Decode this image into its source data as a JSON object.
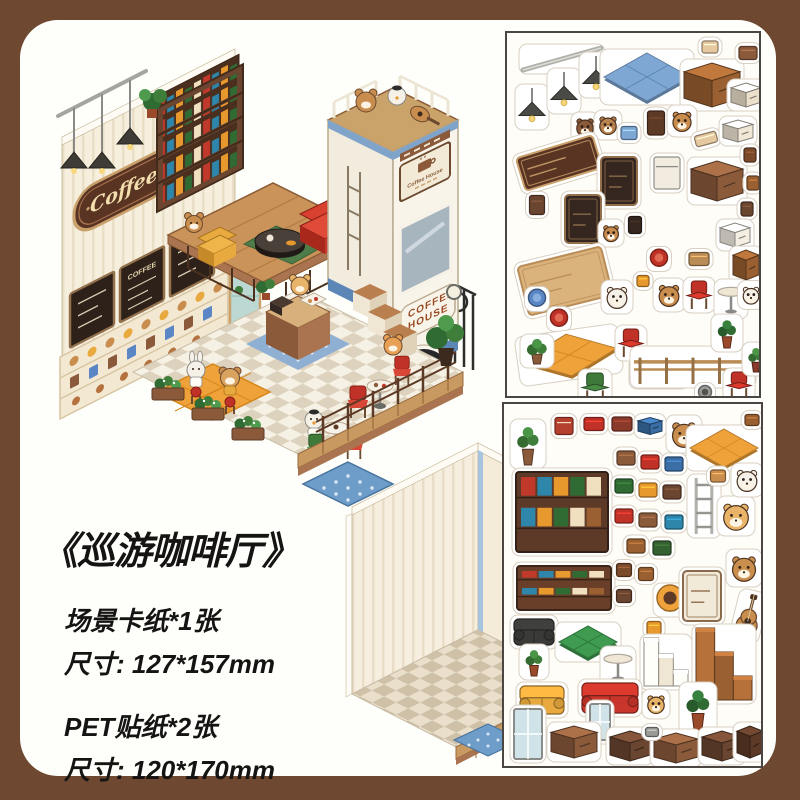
{
  "colors": {
    "frame_brown": "#6e4830",
    "panel_bg": "#fefffb",
    "sheet_bg": "#fffdf8",
    "sheet_border": "#4b4641",
    "accent_red": "#c0392b",
    "accent_orange": "#f0a23a",
    "accent_blue": "#7fa7d4",
    "accent_green": "#3e7d3a",
    "wood_brown": "#8a5a3b"
  },
  "title": "《巡游咖啡厅》",
  "specs": [
    {
      "line": "场景卡纸*1张",
      "size": "尺寸: 127*157mm"
    },
    {
      "line": "PET贴纸*2张",
      "size": "尺寸: 120*170mm"
    }
  ],
  "scene": {
    "name": "coffee-shop-isometric-scene",
    "sign_text": "Coffee",
    "menu_text": "COFFEE",
    "truck_text_line1": "COFFEE",
    "truck_text_line2": "HOUSE",
    "truck_sign_text": "Coffee House"
  },
  "sheets": {
    "top": {
      "name": "pet-sticker-sheet-1",
      "stickers": [
        {
          "n": "curtain-rod",
          "k": "rod",
          "x": 55,
          "y": 26,
          "w": 78,
          "h": 22,
          "c": "#b0b0aa"
        },
        {
          "n": "hanging-lamp",
          "k": "lamp",
          "x": 25,
          "y": 74,
          "w": 26,
          "h": 38,
          "c": "#4a4a46"
        },
        {
          "n": "hanging-lamp",
          "k": "lamp",
          "x": 57,
          "y": 58,
          "w": 26,
          "h": 38,
          "c": "#4a4a46"
        },
        {
          "n": "hanging-lamp",
          "k": "lamp",
          "x": 89,
          "y": 42,
          "w": 26,
          "h": 38,
          "c": "#4a4a46"
        },
        {
          "n": "blue-tile-mat",
          "k": "flat",
          "x": 140,
          "y": 44,
          "w": 86,
          "h": 48,
          "c": "#7fa7d4",
          "c2": "#5b86b5"
        },
        {
          "n": "bun",
          "k": "small",
          "x": 203,
          "y": 14,
          "w": 16,
          "h": 12,
          "c": "#e7c9a1"
        },
        {
          "n": "brown-cabinet",
          "k": "cube",
          "x": 205,
          "y": 52,
          "w": 56,
          "h": 44,
          "c": "#9a6031"
        },
        {
          "n": "snack-tray",
          "k": "small",
          "x": 241,
          "y": 20,
          "w": 18,
          "h": 13,
          "c": "#8a5a3b"
        },
        {
          "n": "white-bench",
          "k": "cube",
          "x": 239,
          "y": 62,
          "w": 30,
          "h": 24,
          "c": "#ece0cc"
        },
        {
          "n": "barista-bear",
          "k": "char",
          "x": 78,
          "y": 94,
          "w": 20,
          "h": 22,
          "c": "#8a5a3b"
        },
        {
          "n": "barista-bear",
          "k": "char",
          "x": 101,
          "y": 92,
          "w": 20,
          "h": 22,
          "c": "#b98350"
        },
        {
          "n": "blue-crate",
          "k": "small",
          "x": 122,
          "y": 100,
          "w": 16,
          "h": 13,
          "c": "#7fa7d4"
        },
        {
          "n": "coffee-grinder",
          "k": "small",
          "x": 149,
          "y": 90,
          "w": 17,
          "h": 24,
          "c": "#5d3a26"
        },
        {
          "n": "bear-on-chair",
          "k": "char",
          "x": 175,
          "y": 88,
          "w": 22,
          "h": 24,
          "c": "#c98d4e"
        },
        {
          "n": "bread",
          "k": "small",
          "x": 199,
          "y": 106,
          "w": 22,
          "h": 11,
          "c": "#e7c9a1",
          "r": -15
        },
        {
          "n": "bread-box",
          "k": "cube",
          "x": 231,
          "y": 98,
          "w": 30,
          "h": 22,
          "c": "#f0e7d6"
        },
        {
          "n": "coffee-sign",
          "k": "panel",
          "x": 52,
          "y": 130,
          "w": 80,
          "h": 34,
          "c": "#5a3423",
          "c2": "#caa06b",
          "r": -17
        },
        {
          "n": "menu-board",
          "k": "panel",
          "x": 112,
          "y": 148,
          "w": 36,
          "h": 48,
          "c": "#35271f",
          "c2": "#93704c"
        },
        {
          "n": "coffee-machine",
          "k": "small",
          "x": 160,
          "y": 140,
          "w": 26,
          "h": 32,
          "c": "#f2ece0",
          "c2": "#8a8a86"
        },
        {
          "n": "counter-cube",
          "k": "cube",
          "x": 210,
          "y": 148,
          "w": 52,
          "h": 40,
          "c": "#8a5a3b"
        },
        {
          "n": "jar",
          "k": "small",
          "x": 243,
          "y": 122,
          "w": 12,
          "h": 14,
          "c": "#7a4a2a"
        },
        {
          "n": "jar",
          "k": "small",
          "x": 246,
          "y": 150,
          "w": 12,
          "h": 14,
          "c": "#9a6031"
        },
        {
          "n": "jar",
          "k": "small",
          "x": 240,
          "y": 176,
          "w": 12,
          "h": 14,
          "c": "#6a4530"
        },
        {
          "n": "menu-board",
          "k": "panel",
          "x": 76,
          "y": 186,
          "w": 36,
          "h": 48,
          "c": "#35271f",
          "c2": "#93704c"
        },
        {
          "n": "wall-frame",
          "k": "small",
          "x": 30,
          "y": 172,
          "w": 15,
          "h": 19,
          "c": "#6a4530"
        },
        {
          "n": "glass-cover",
          "k": "cube",
          "x": 228,
          "y": 202,
          "w": 30,
          "h": 24,
          "c": "#f5efe3"
        },
        {
          "n": "bear-face",
          "k": "char",
          "x": 104,
          "y": 200,
          "w": 18,
          "h": 20,
          "c": "#c98d4e"
        },
        {
          "n": "wall-frame",
          "k": "small",
          "x": 128,
          "y": 192,
          "w": 13,
          "h": 17,
          "c": "#35271f"
        },
        {
          "n": "red-stool",
          "k": "round",
          "x": 152,
          "y": 226,
          "w": 17,
          "h": 17,
          "c": "#c03227",
          "c2": "#e06a54"
        },
        {
          "n": "wood-wall-panel",
          "k": "panel",
          "x": 58,
          "y": 248,
          "w": 86,
          "h": 50,
          "c": "#d9b27c",
          "c2": "#b98c55",
          "r": -14
        },
        {
          "n": "basket",
          "k": "small",
          "x": 192,
          "y": 226,
          "w": 20,
          "h": 13,
          "c": "#b98c55"
        },
        {
          "n": "display-case",
          "k": "cube",
          "x": 239,
          "y": 232,
          "w": 26,
          "h": 30,
          "c": "#9a6031"
        },
        {
          "n": "blue-stool",
          "k": "round",
          "x": 30,
          "y": 266,
          "w": 17,
          "h": 17,
          "c": "#5b86c5",
          "c2": "#88aede"
        },
        {
          "n": "red-stool",
          "k": "round",
          "x": 52,
          "y": 286,
          "w": 17,
          "h": 17,
          "c": "#c03227",
          "c2": "#e06a54"
        },
        {
          "n": "rabbit",
          "k": "char",
          "x": 110,
          "y": 264,
          "w": 24,
          "h": 26,
          "c": "#f5f1e8"
        },
        {
          "n": "coffee-cup",
          "k": "small",
          "x": 136,
          "y": 248,
          "w": 12,
          "h": 11,
          "c": "#e8992d"
        },
        {
          "n": "bear",
          "k": "char",
          "x": 162,
          "y": 262,
          "w": 24,
          "h": 26,
          "c": "#c98d4e"
        },
        {
          "n": "red-chair",
          "k": "chair",
          "x": 192,
          "y": 262,
          "w": 24,
          "h": 28,
          "c": "#c03227"
        },
        {
          "n": "round-table",
          "k": "table",
          "x": 224,
          "y": 266,
          "w": 26,
          "h": 32,
          "c": "#efe6d4",
          "c2": "#8a8a86"
        },
        {
          "n": "duck",
          "k": "char",
          "x": 244,
          "y": 262,
          "w": 19,
          "h": 21,
          "c": "#f5f1e8"
        },
        {
          "n": "orange-tile-mat",
          "k": "flat",
          "x": 62,
          "y": 322,
          "w": 96,
          "h": 42,
          "c": "#f0a23a",
          "c2": "#d6871d",
          "r": -8
        },
        {
          "n": "red-chair",
          "k": "chair",
          "x": 124,
          "y": 310,
          "w": 24,
          "h": 28,
          "c": "#c03227"
        },
        {
          "n": "striped-rug",
          "k": "rug",
          "x": 152,
          "y": 340,
          "w": 52,
          "h": 24,
          "c": "#e9f0e2",
          "c2": "#7ab97a"
        },
        {
          "n": "green-chair",
          "k": "chair",
          "x": 88,
          "y": 354,
          "w": 26,
          "h": 28,
          "c": "#3f7a3b"
        },
        {
          "n": "wood-fence",
          "k": "fence",
          "x": 186,
          "y": 334,
          "w": 118,
          "h": 34,
          "c": "#b98c55"
        },
        {
          "n": "planter-box",
          "k": "plant",
          "x": 30,
          "y": 318,
          "w": 26,
          "h": 26,
          "c": "#3e7d3a",
          "c2": "#8a5a3b"
        },
        {
          "n": "potted-plant",
          "k": "plant",
          "x": 220,
          "y": 300,
          "w": 24,
          "h": 30,
          "c": "#2f6b33",
          "c2": "#9a4a2a"
        },
        {
          "n": "red-chair",
          "k": "chair",
          "x": 232,
          "y": 352,
          "w": 24,
          "h": 26,
          "c": "#c03227"
        },
        {
          "n": "potted-plant",
          "k": "plant",
          "x": 249,
          "y": 326,
          "w": 20,
          "h": 26,
          "c": "#3e7d3a",
          "c2": "#8a3a2a"
        },
        {
          "n": "pet-bowl",
          "k": "round",
          "x": 198,
          "y": 360,
          "w": 13,
          "h": 13,
          "c": "#9a9a96",
          "c2": "#55514d"
        }
      ]
    },
    "bottom": {
      "name": "pet-sticker-sheet-2",
      "stickers": [
        {
          "n": "hanging-plant",
          "k": "plant",
          "x": 24,
          "y": 40,
          "w": 28,
          "h": 42,
          "c": "#3e7d3a",
          "c2": "#8a5a3b"
        },
        {
          "n": "wall-frame",
          "k": "small",
          "x": 60,
          "y": 22,
          "w": 18,
          "h": 17,
          "c": "#b5402f",
          "c2": "#f0e0c0"
        },
        {
          "n": "bento",
          "k": "small",
          "x": 90,
          "y": 20,
          "w": 20,
          "h": 13,
          "c": "#c03227"
        },
        {
          "n": "books-stack",
          "k": "small",
          "x": 118,
          "y": 20,
          "w": 20,
          "h": 14,
          "c": "#8a3a2a"
        },
        {
          "n": "blue-tray",
          "k": "cube",
          "x": 146,
          "y": 22,
          "w": 24,
          "h": 17,
          "c": "#3a6ea5"
        },
        {
          "n": "bear-reading",
          "k": "char",
          "x": 180,
          "y": 30,
          "w": 28,
          "h": 30,
          "c": "#c98d4e"
        },
        {
          "n": "orange-mat",
          "k": "flat",
          "x": 220,
          "y": 44,
          "w": 68,
          "h": 38,
          "c": "#f0a23a",
          "c2": "#d6871d"
        },
        {
          "n": "snack",
          "k": "small",
          "x": 248,
          "y": 16,
          "w": 14,
          "h": 11,
          "c": "#9a6031"
        },
        {
          "n": "bookshelf",
          "k": "shelf",
          "x": 58,
          "y": 108,
          "w": 92,
          "h": 80,
          "c": "#5d3a28"
        },
        {
          "n": "book-sticker",
          "k": "small",
          "x": 122,
          "y": 54,
          "w": 18,
          "h": 14,
          "c": "#8a5a3b"
        },
        {
          "n": "book-sticker",
          "k": "small",
          "x": 146,
          "y": 58,
          "w": 18,
          "h": 14,
          "c": "#c03227"
        },
        {
          "n": "book-sticker",
          "k": "small",
          "x": 170,
          "y": 60,
          "w": 18,
          "h": 14,
          "c": "#3a6ea5"
        },
        {
          "n": "book-sticker",
          "k": "small",
          "x": 120,
          "y": 82,
          "w": 18,
          "h": 14,
          "c": "#2f6b33"
        },
        {
          "n": "book-sticker",
          "k": "small",
          "x": 144,
          "y": 86,
          "w": 18,
          "h": 14,
          "c": "#e8992d"
        },
        {
          "n": "book-sticker",
          "k": "small",
          "x": 168,
          "y": 88,
          "w": 18,
          "h": 14,
          "c": "#6a4530"
        },
        {
          "n": "book-sticker",
          "k": "small",
          "x": 120,
          "y": 112,
          "w": 18,
          "h": 14,
          "c": "#c03227"
        },
        {
          "n": "book-sticker",
          "k": "small",
          "x": 144,
          "y": 116,
          "w": 18,
          "h": 14,
          "c": "#8a5a3b"
        },
        {
          "n": "book-sticker",
          "k": "small",
          "x": 170,
          "y": 118,
          "w": 18,
          "h": 14,
          "c": "#2e86ab"
        },
        {
          "n": "book-sticker",
          "k": "small",
          "x": 132,
          "y": 142,
          "w": 18,
          "h": 14,
          "c": "#9a6031"
        },
        {
          "n": "book-sticker",
          "k": "small",
          "x": 158,
          "y": 144,
          "w": 18,
          "h": 14,
          "c": "#35602f"
        },
        {
          "n": "ladder",
          "k": "ladder",
          "x": 200,
          "y": 102,
          "w": 26,
          "h": 56,
          "c": "#b0b0aa"
        },
        {
          "n": "bear",
          "k": "char",
          "x": 232,
          "y": 112,
          "w": 30,
          "h": 32,
          "c": "#e8b46a"
        },
        {
          "n": "white-cat",
          "k": "char",
          "x": 243,
          "y": 76,
          "w": 24,
          "h": 26,
          "c": "#f5f1e8"
        },
        {
          "n": "cookie",
          "k": "small",
          "x": 214,
          "y": 72,
          "w": 15,
          "h": 12,
          "c": "#c98d4e"
        },
        {
          "n": "tv-console",
          "k": "shelf",
          "x": 60,
          "y": 184,
          "w": 94,
          "h": 44,
          "c": "#6a3f2a"
        },
        {
          "n": "jar",
          "k": "small",
          "x": 120,
          "y": 166,
          "w": 15,
          "h": 13,
          "c": "#7a4a2a"
        },
        {
          "n": "jar",
          "k": "small",
          "x": 142,
          "y": 170,
          "w": 15,
          "h": 13,
          "c": "#9a6031"
        },
        {
          "n": "jar",
          "k": "small",
          "x": 120,
          "y": 192,
          "w": 15,
          "h": 13,
          "c": "#6a4530"
        },
        {
          "n": "record-player",
          "k": "round",
          "x": 166,
          "y": 196,
          "w": 26,
          "h": 26,
          "c": "#f0a23a",
          "c2": "#5d3a26"
        },
        {
          "n": "menu-poster",
          "k": "panel",
          "x": 198,
          "y": 192,
          "w": 38,
          "h": 50,
          "c": "#f2ead8",
          "c2": "#8a6a4a"
        },
        {
          "n": "bear",
          "k": "char",
          "x": 240,
          "y": 164,
          "w": 28,
          "h": 30,
          "c": "#c98d4e"
        },
        {
          "n": "guitar",
          "k": "guitar",
          "x": 245,
          "y": 212,
          "w": 22,
          "h": 44,
          "c": "#c98d4e",
          "r": 14
        },
        {
          "n": "black-armchair",
          "k": "sofa",
          "x": 30,
          "y": 228,
          "w": 40,
          "h": 26,
          "c": "#3a3a38"
        },
        {
          "n": "green-table",
          "k": "flat",
          "x": 84,
          "y": 238,
          "w": 58,
          "h": 32,
          "c": "#3f9b4f",
          "c2": "#2f7a3b"
        },
        {
          "n": "potted-plant",
          "k": "plant",
          "x": 30,
          "y": 258,
          "w": 22,
          "h": 28,
          "c": "#3e7d3a",
          "c2": "#9a4a2a"
        },
        {
          "n": "coffee-pot",
          "k": "small",
          "x": 150,
          "y": 224,
          "w": 14,
          "h": 13,
          "c": "#e8992d"
        },
        {
          "n": "white-stairs",
          "k": "stairs",
          "x": 162,
          "y": 258,
          "w": 44,
          "h": 48,
          "c": "#efe6d4"
        },
        {
          "n": "brown-stairs",
          "k": "stairs",
          "x": 220,
          "y": 260,
          "w": 56,
          "h": 72,
          "c": "#9a6031"
        },
        {
          "n": "round-table",
          "k": "table",
          "x": 114,
          "y": 262,
          "w": 28,
          "h": 32,
          "c": "#f0e7d6",
          "c2": "#8a8a86"
        },
        {
          "n": "yellow-sofa",
          "k": "sofa",
          "x": 38,
          "y": 296,
          "w": 44,
          "h": 28,
          "c": "#e8a93e"
        },
        {
          "n": "red-sofa",
          "k": "sofa",
          "x": 106,
          "y": 294,
          "w": 56,
          "h": 30,
          "c": "#c8352a"
        },
        {
          "n": "tall-plant",
          "k": "plant",
          "x": 194,
          "y": 304,
          "w": 30,
          "h": 44,
          "c": "#2f6b33",
          "c2": "#9a4a2a"
        },
        {
          "n": "glass-door",
          "k": "window",
          "x": 24,
          "y": 330,
          "w": 28,
          "h": 50,
          "c": "#cfe3e8"
        },
        {
          "n": "bear-bun",
          "k": "char",
          "x": 152,
          "y": 300,
          "w": 20,
          "h": 22,
          "c": "#e8b46a"
        },
        {
          "n": "mirror",
          "k": "window",
          "x": 96,
          "y": 318,
          "w": 20,
          "h": 36,
          "c": "#cfe3e8"
        },
        {
          "n": "cabinet",
          "k": "cube",
          "x": 70,
          "y": 338,
          "w": 46,
          "h": 32,
          "c": "#8a5a3b"
        },
        {
          "n": "cabinet",
          "k": "cube",
          "x": 126,
          "y": 342,
          "w": 40,
          "h": 30,
          "c": "#6a4530"
        },
        {
          "n": "cabinet",
          "k": "cube",
          "x": 172,
          "y": 344,
          "w": 44,
          "h": 30,
          "c": "#8a5a3b"
        },
        {
          "n": "cabinet",
          "k": "cube",
          "x": 218,
          "y": 342,
          "w": 40,
          "h": 30,
          "c": "#6a4530"
        },
        {
          "n": "nightstand",
          "k": "cube",
          "x": 246,
          "y": 338,
          "w": 26,
          "h": 32,
          "c": "#5d3a28"
        },
        {
          "n": "bowl",
          "k": "small",
          "x": 148,
          "y": 328,
          "w": 13,
          "h": 9,
          "c": "#9a9a96"
        }
      ]
    }
  },
  "card": {
    "name": "empty-scene-card"
  }
}
